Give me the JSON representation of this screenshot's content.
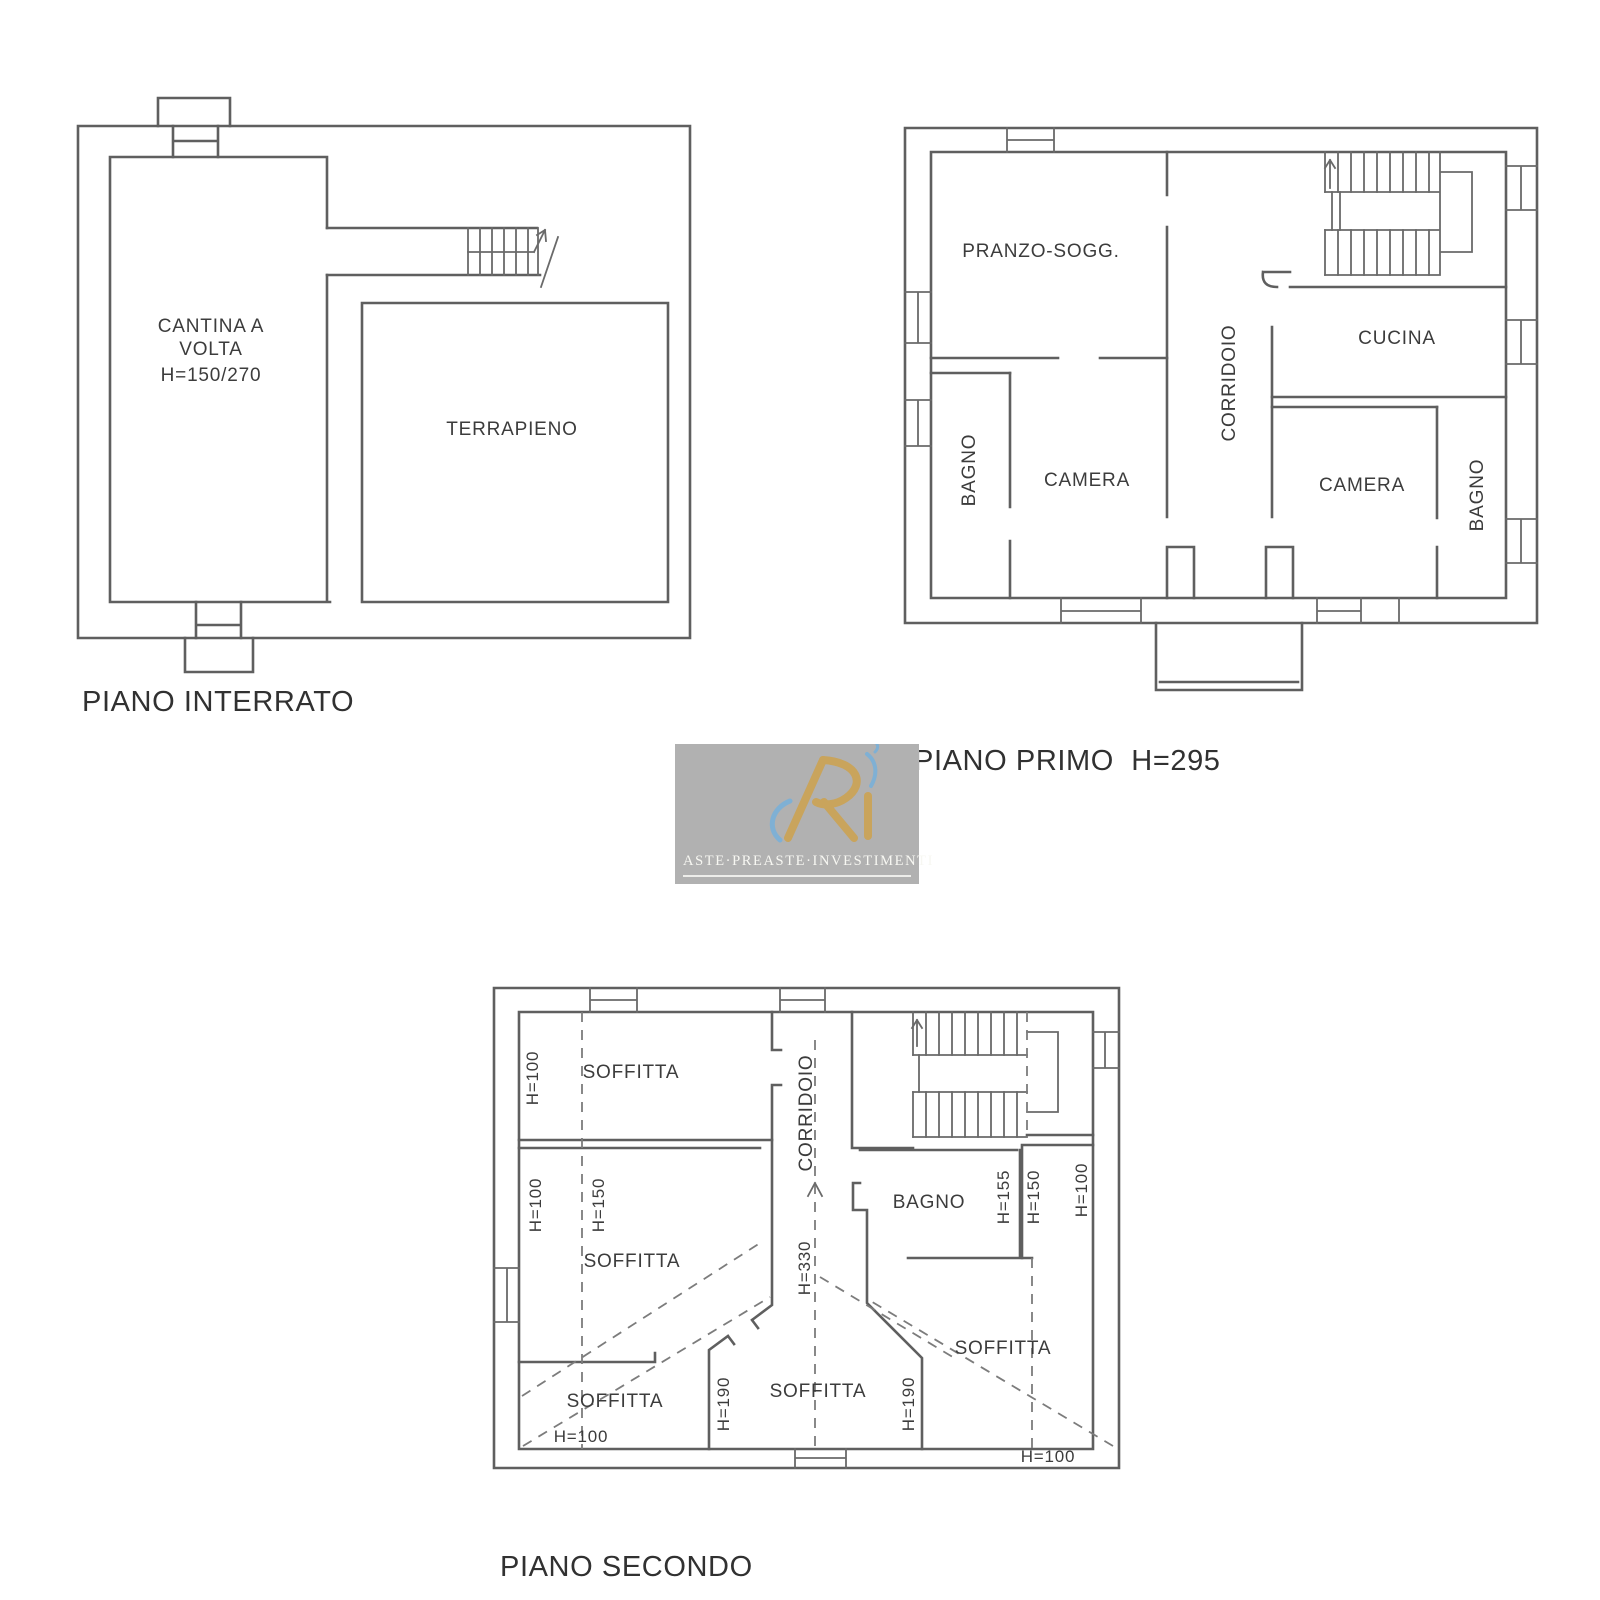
{
  "document": {
    "type": "floor-plans",
    "background": "#ffffff"
  },
  "colors": {
    "plan_line": "#5f5f5f",
    "label_text": "#3c3c3c",
    "title_text": "#313131",
    "watermark_bg": "#b1b1b1",
    "watermark_gold": "#c9a45c",
    "watermark_blue": "#7fb0d4",
    "watermark_text": "#f7f7f2"
  },
  "watermark": {
    "monogram": "R",
    "brand": "ASTE·PREASTE·INVESTIMENTI"
  },
  "plans": {
    "interrato": {
      "title": "PIANO INTERRATO",
      "labels": {
        "cantina_1": "CANTINA A",
        "cantina_2": "VOLTA",
        "cantina_3": "H=150/270",
        "terrapieno": "TERRAPIENO"
      }
    },
    "primo": {
      "title": "PIANO PRIMO  H=295",
      "labels": {
        "pranzo": "PRANZO-SOGG.",
        "corridoio": "CORRIDOIO",
        "cucina": "CUCINA",
        "bagno_sx": "BAGNO",
        "camera_sx": "CAMERA",
        "camera_dx": "CAMERA",
        "bagno_dx": "BAGNO"
      }
    },
    "secondo": {
      "title": "PIANO SECONDO",
      "labels": {
        "soffitta_nw": "SOFFITTA",
        "h100_nw": "H=100",
        "h100_w": "H=100",
        "h150_w": "H=150",
        "soffitta_w": "SOFFITTA",
        "corridoio": "CORRIDOIO",
        "h330": "H=330",
        "bagno": "BAGNO",
        "h155_e": "H=155",
        "h150_e": "H=150",
        "h100_e": "H=100",
        "soffitta_e": "SOFFITTA",
        "h100_se": "H=100",
        "soffitta_sw": "SOFFITTA",
        "h100_sw": "H=100",
        "soffitta_s": "SOFFITTA",
        "h190_sl": "H=190",
        "h190_sr": "H=190"
      }
    }
  }
}
